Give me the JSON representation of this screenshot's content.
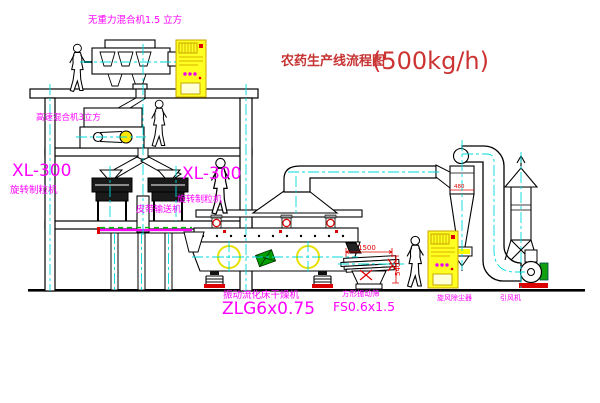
{
  "title": {
    "main": "农药生产线流程图",
    "capacity": "(500kg/h)"
  },
  "labels": {
    "gravity_mixer": "无重力混合机1.5 立方",
    "high_speed_mixer": "高速混合机3立方",
    "granulator_left_model": "XL-300",
    "granulator_left_name": "旋转制粒机",
    "granulator_center_model": "XL-300",
    "granulator_center_name": "旋转制粒机",
    "belt_conveyor": "皮带输送机",
    "fluid_bed_dryer": "振动流化床干燥机",
    "fluid_bed_dryer_model": "ZLG6x0.75",
    "square_sieve": "方形振动筛",
    "square_sieve_model": "FS0.6x1.5",
    "cyclone_dust_collector": "旋风除尘器",
    "induced_draft_fan": "引风机"
  },
  "dimensions": {
    "sieve_length": "1500",
    "sieve_height": "540",
    "cyclone_dim": "480"
  },
  "colors": {
    "line": "#000000",
    "centerline": "#00d9d9",
    "label_magenta": "#ff00ff",
    "title_red": "#c63434",
    "dimension_red": "#dd0000",
    "cabinet_yellow": "#ffff22",
    "machine_green": "#00a000",
    "base_red": "#dd0000",
    "crosshair_yellow": "#e8e000"
  }
}
